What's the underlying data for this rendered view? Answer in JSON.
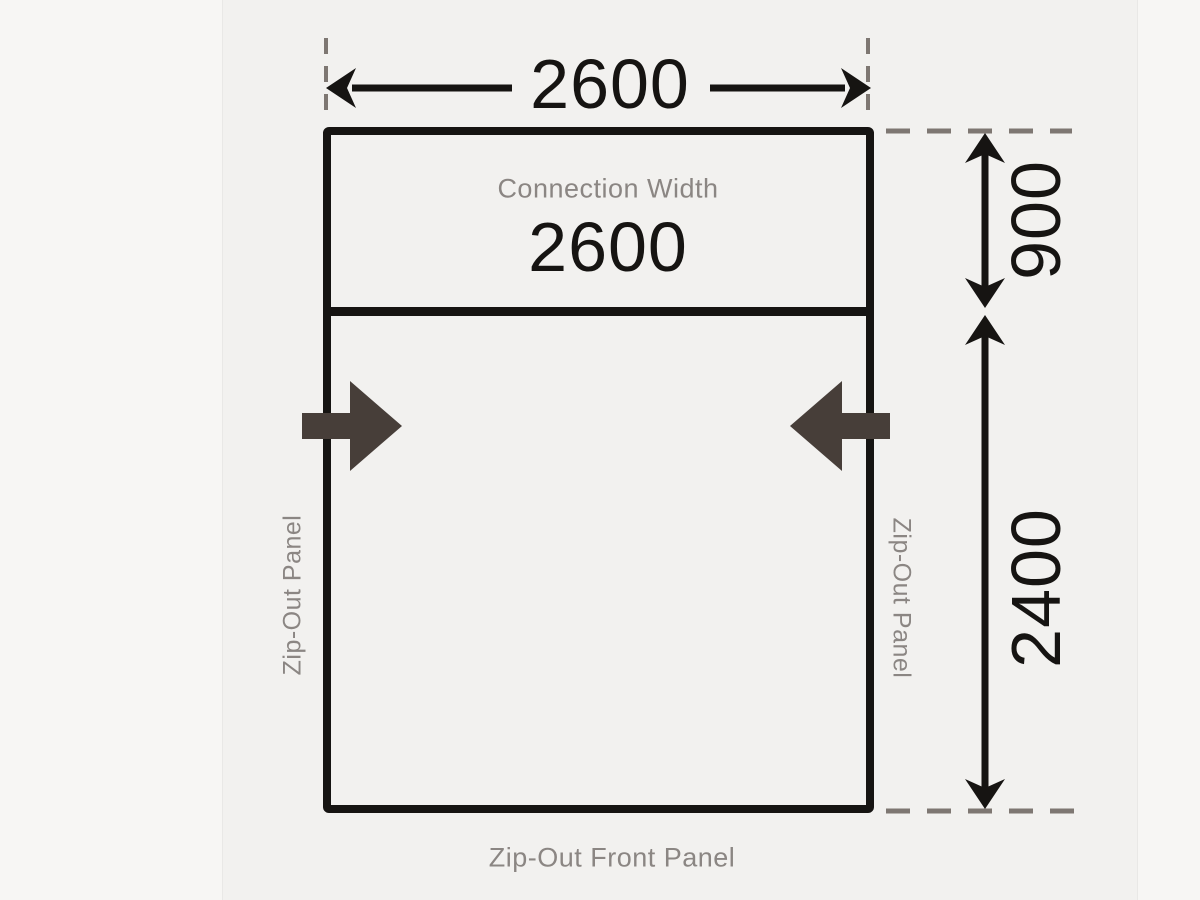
{
  "diagram": {
    "top_width_value": "2600",
    "connection_width_label": "Connection Width",
    "connection_width_value": "2600",
    "connection_depth_value": "900",
    "main_depth_value": "2400",
    "left_panel_label": "Zip-Out Panel",
    "right_panel_label": "Zip-Out Panel",
    "front_panel_label": "Zip-Out Front Panel",
    "colors": {
      "line": "#161412",
      "label-gray": "#8b8683",
      "dash-gray": "#7e7772",
      "arrow-dark": "#473e39",
      "bg-inner": "#f2f1ef",
      "bg-outer": "#f7f6f4"
    }
  }
}
